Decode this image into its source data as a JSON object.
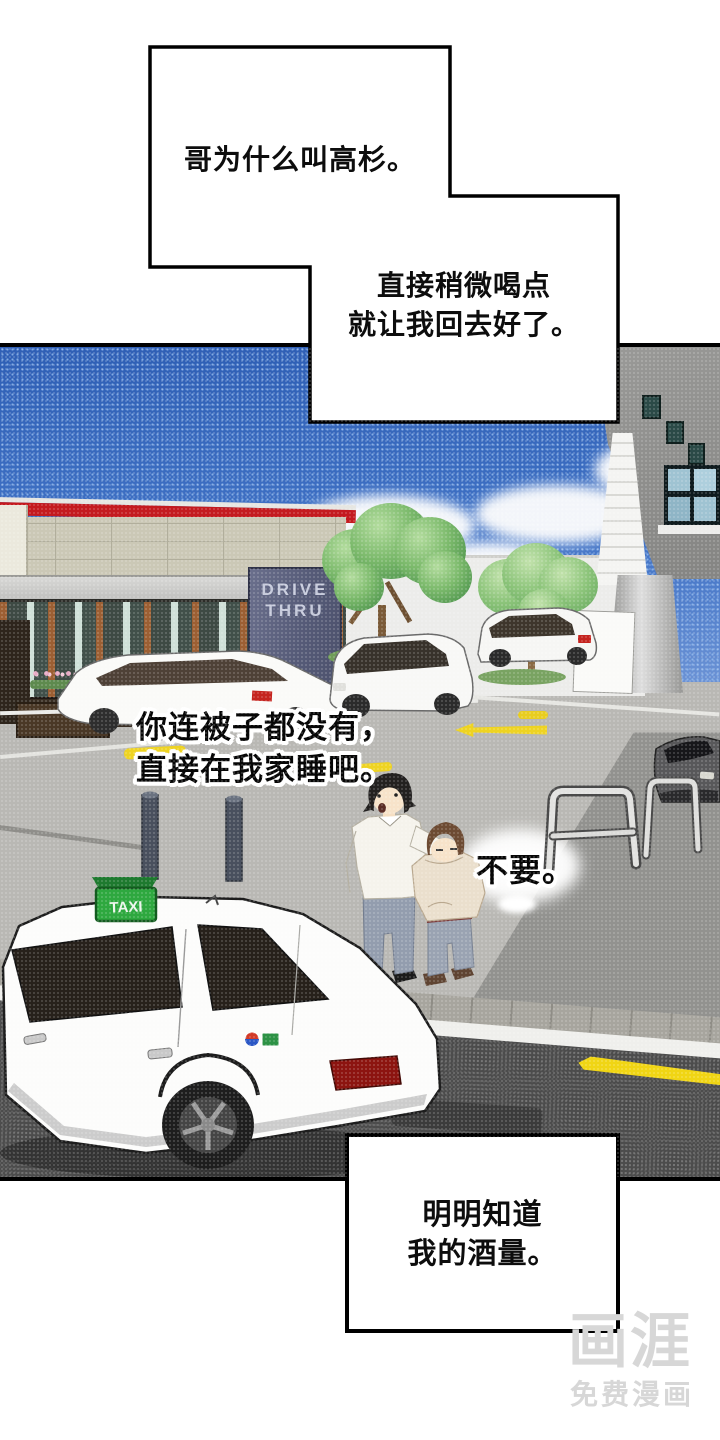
{
  "speech": {
    "box1": {
      "text": "哥为什么叫高杉。"
    },
    "box2": {
      "line1": "直接稍微喝点",
      "line2": "就让我回去好了。"
    },
    "shout1": {
      "line1": "你连被子都没有，",
      "line2": "直接在我家睡吧。"
    },
    "shout2": {
      "text": "不要。"
    },
    "box3": {
      "line1": "明明知道",
      "line2": "我的酒量。"
    }
  },
  "scene": {
    "drive_thru_sign": {
      "line1": "DRIVE",
      "line2": "THRU"
    },
    "taxi_roof_sign": "TAXI"
  },
  "watermark": {
    "logo": "画涯",
    "tagline": "免费漫画"
  },
  "colors": {
    "sky": "#3a6cc2",
    "sign_purple": "#5d6280",
    "taxi_green": "#2ea83f",
    "road": "#4c4c4c",
    "parking_lot": "#b9b8b4",
    "marking_yellow": "#eed322",
    "roof_stripe_red": "#c41a1f",
    "watermark_gray": "#d7d7d7"
  }
}
